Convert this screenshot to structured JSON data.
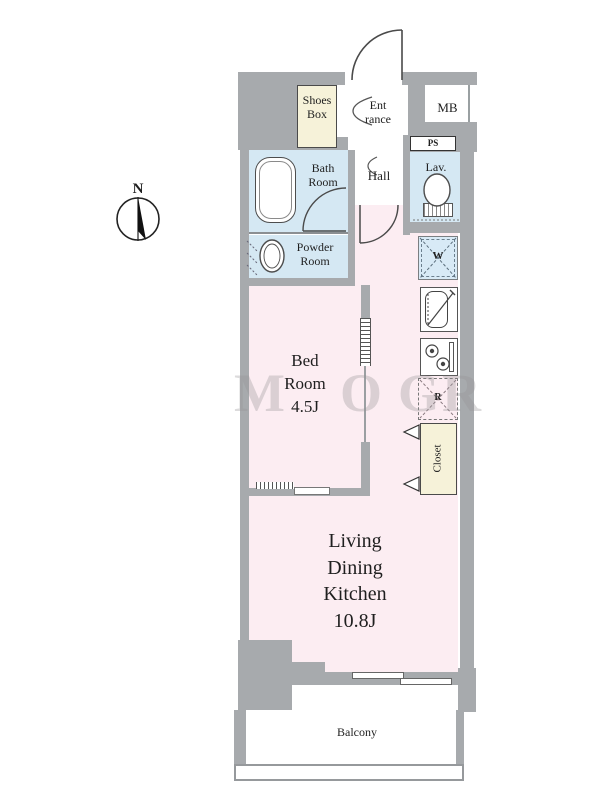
{
  "plan_title": "1K apartment floor plan",
  "compass": {
    "label": "N"
  },
  "rooms": {
    "shoes_box": {
      "line1": "Shoes",
      "line2": "Box"
    },
    "entrance": {
      "line1": "Ent",
      "line2": "rance"
    },
    "mb": {
      "label": "MB"
    },
    "ps": {
      "label": "PS"
    },
    "lav": {
      "label": "Lav."
    },
    "hall": {
      "label": "Hall"
    },
    "bath": {
      "line1": "Bath",
      "line2": "Room"
    },
    "powder": {
      "line1": "Powder",
      "line2": "Room"
    },
    "bedroom": {
      "line1": "Bed",
      "line2": "Room",
      "size": "4.5J"
    },
    "ldk": {
      "line1": "Living",
      "line2": "Dining",
      "line3": "Kitchen",
      "size": "10.8J"
    },
    "closet": {
      "label": "Closet"
    },
    "balcony": {
      "label": "Balcony"
    }
  },
  "fixtures": {
    "washer": {
      "label": "W"
    },
    "fridge": {
      "label": "R"
    }
  },
  "watermark": {
    "letters": [
      "M",
      "O",
      "G",
      "R"
    ]
  },
  "colors": {
    "wall_gray": "#a7aaad",
    "room_pink": "#fcedf2",
    "wet_area_blue": "#d5e8f3",
    "cabinet_cream": "#f6f2d9",
    "line_dark": "#3c3c3c"
  }
}
